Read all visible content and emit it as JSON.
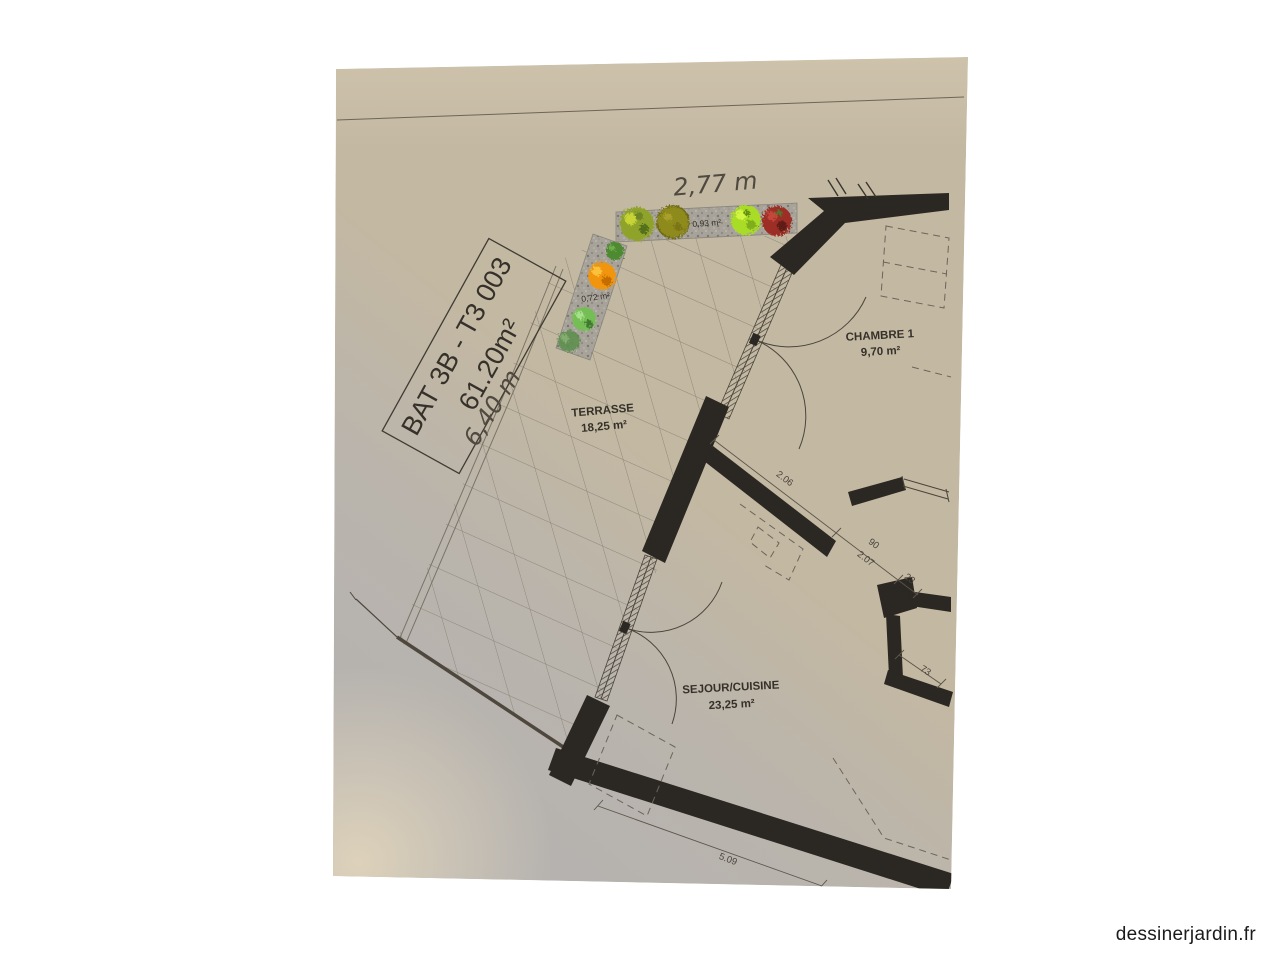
{
  "site": {
    "watermark": "dessinerjardin.fr"
  },
  "plan": {
    "title_box": {
      "line1": "BAT 3B - T3 003",
      "line2": "61.20m²"
    },
    "handwritten": {
      "width_top": "2,77 m",
      "length_left": "6,40 m"
    },
    "rooms": [
      {
        "id": "terrasse",
        "name": "TERRASSE",
        "area": "18,25 m²"
      },
      {
        "id": "chambre1",
        "name": "CHAMBRE 1",
        "area": "9,70 m²"
      },
      {
        "id": "sejour",
        "name": "SEJOUR/CUISINE",
        "area": "23,25 m²"
      }
    ],
    "planters": [
      {
        "area": "0,93 m²"
      },
      {
        "area": "0,72 m²"
      }
    ],
    "dimensions": {
      "wall_sejour": "2.06",
      "door_clear": "90",
      "door_total": "2.07",
      "jamb": "23",
      "wall_right": "73",
      "facade_south": "5.09"
    }
  },
  "colors": {
    "paper": "#c3b8a2",
    "paper-shadow": "#b2b1b4",
    "paper-light": "#e0d3ba",
    "wall": "#2b2722",
    "line": "#5b544a",
    "grid-line": "#8b8376",
    "gravel": "#a7a39a",
    "text-dark": "#35312a",
    "dim-text": "#4a443c",
    "hand": "#50493f",
    "bush-yellowgreen": "#8fa32c",
    "tree-olive": "#8f8a1c",
    "plant-chartreuse": "#a8dc28",
    "plant-red": "#9c2f27",
    "plant-green": "#4d8a33",
    "plant-orange": "#f09507",
    "plant-lightgreen": "#74bd55",
    "plant-darkgreen": "#5b8f4a"
  }
}
